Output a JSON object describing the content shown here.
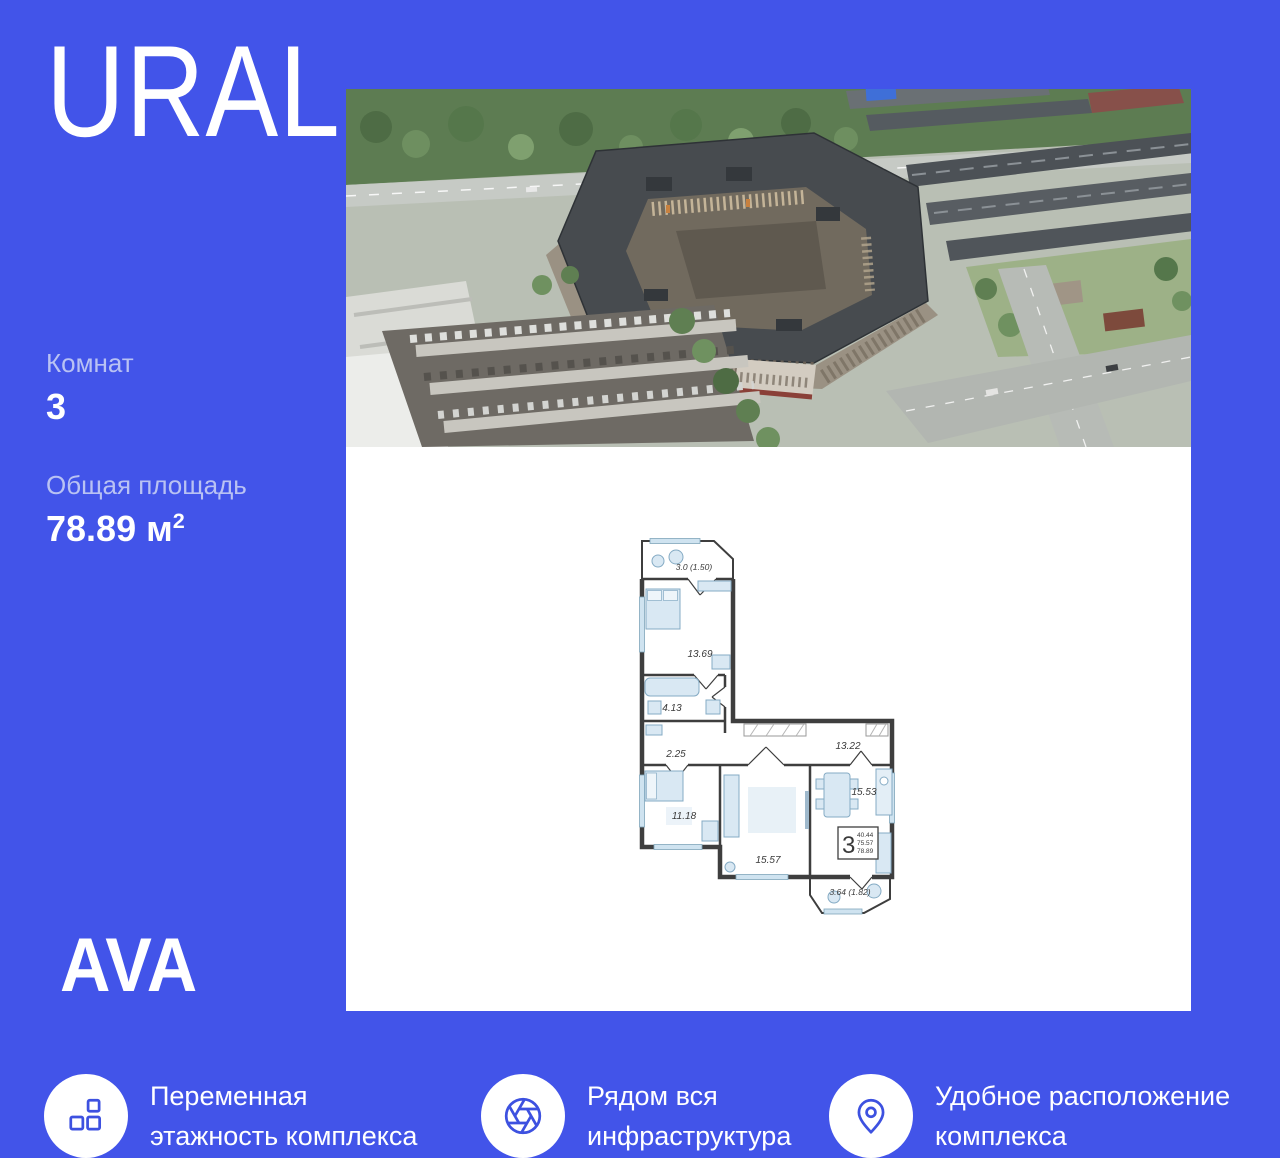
{
  "theme": {
    "background": "#4254E9",
    "panel": "#FFFFFF",
    "icon_accent": "#3D51E0",
    "muted_text": "#B9C2F3",
    "plan_wall": "#3E3E3E"
  },
  "header": {
    "logo": "URAL"
  },
  "stats": {
    "rooms_label": "Комнат",
    "rooms_value": "3",
    "area_label": "Общая площадь",
    "area_value": "78.89 м",
    "area_sup": "2"
  },
  "floor_plan": {
    "labels": {
      "balcony_top": "3.0 (1.50)",
      "bedroom1": "13.69",
      "bathroom": "4.13",
      "hall": "2.25",
      "corridor": "13.22",
      "kitchen": "15.53",
      "bedroom2": "11.18",
      "living": "15.57",
      "balcony_bottom": "3.64 (1.82)"
    },
    "stamp": {
      "rooms": "3",
      "upper": "40.44",
      "middle": "75.57",
      "lower": "78.89"
    }
  },
  "footer": {
    "logo": "AVA"
  },
  "features": [
    {
      "icon": "blocks-icon",
      "line1": "Переменная",
      "line2": "этажность комплекса"
    },
    {
      "icon": "aperture-icon",
      "line1": "Рядом вся",
      "line2": "инфраструктура"
    },
    {
      "icon": "location-pin-icon",
      "line1": "Удобное расположение",
      "line2": "комплекса"
    }
  ]
}
